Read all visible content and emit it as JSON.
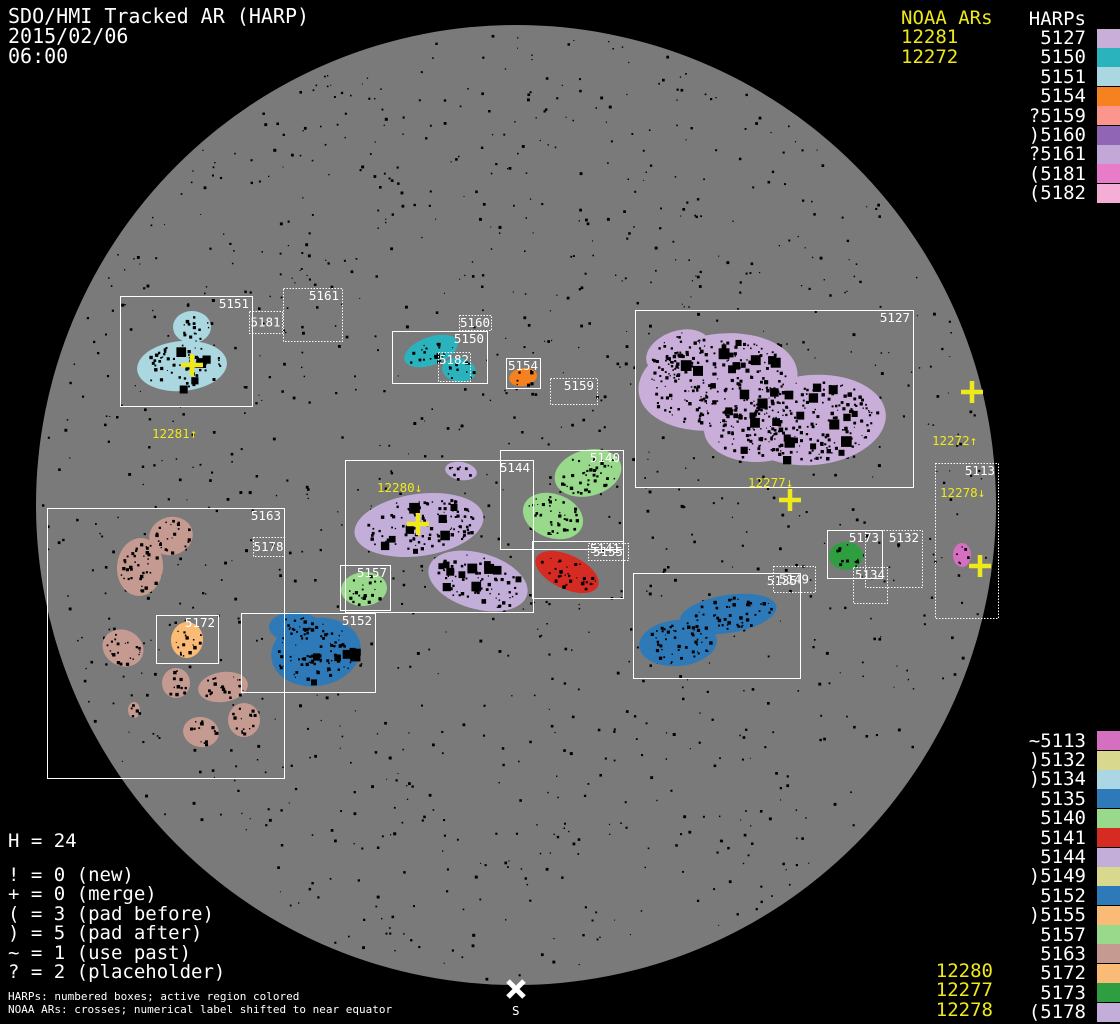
{
  "title": {
    "line1": "SDO/HMI Tracked AR (HARP)",
    "line2": "2015/02/06",
    "line3": "06:00"
  },
  "colors": {
    "background": "#000000",
    "disk": "#7a7a7a",
    "box_stroke": "#ffffff",
    "noaa_yellow": "#efe919",
    "text_white": "#ffffff"
  },
  "noaa_top": {
    "header": "NOAA ARs",
    "items": [
      "12281",
      "12272"
    ]
  },
  "harps_top": {
    "header": "HARPs",
    "items": [
      {
        "label": "5127",
        "color": "#c9aed9"
      },
      {
        "label": "5150",
        "color": "#2bb3bd"
      },
      {
        "label": "5151",
        "color": "#abd7e0"
      },
      {
        "label": "5154",
        "color": "#f5821f"
      },
      {
        "label": "?5159",
        "color": "#fb958d"
      },
      {
        "label": ")5160",
        "color": "#9065b5"
      },
      {
        "label": "?5161",
        "color": "#c3a8d7"
      },
      {
        "label": "(5181",
        "color": "#e87cc8"
      },
      {
        "label": "(5182",
        "color": "#f4aed6"
      }
    ]
  },
  "harps_bottom": {
    "items": [
      {
        "label": "~5113",
        "color": "#d56fc0"
      },
      {
        "label": ")5132",
        "color": "#d8d98f"
      },
      {
        "label": ")5134",
        "color": "#abd7e5"
      },
      {
        "label": "5135",
        "color": "#2e79b8"
      },
      {
        "label": "5140",
        "color": "#98d98c"
      },
      {
        "label": "5141",
        "color": "#d62b23"
      },
      {
        "label": "5144",
        "color": "#c3aed9"
      },
      {
        "label": ")5149",
        "color": "#d8d98f"
      },
      {
        "label": "5152",
        "color": "#2e79b8"
      },
      {
        "label": ")5155",
        "color": "#f9bb76"
      },
      {
        "label": "5157",
        "color": "#98d98c"
      },
      {
        "label": "5163",
        "color": "#c49a91"
      },
      {
        "label": "5172",
        "color": "#f9bb76"
      },
      {
        "label": "5173",
        "color": "#2f9e41"
      },
      {
        "label": "(5178",
        "color": "#c3aed9"
      }
    ]
  },
  "noaa_bottom": {
    "items": [
      "12280",
      "12277",
      "12278"
    ]
  },
  "stats": {
    "harp_count": "H = 24",
    "legend": [
      "! = 0 (new)",
      "+ = 0 (merge)",
      "( = 3 (pad before)",
      ") = 5 (pad after)",
      "~ = 1 (use past)",
      "? = 2 (placeholder)"
    ]
  },
  "footer": {
    "line1": "HARPs: numbered boxes; active region colored",
    "line2": "NOAA ARs: crosses; numerical label shifted to near equator"
  },
  "south_marker_label": "S",
  "scene": {
    "disk": {
      "cx": 516,
      "cy": 505,
      "r": 480
    },
    "boxes": [
      {
        "id": "5151",
        "x": 120,
        "y": 296,
        "w": 132,
        "h": 110,
        "style": "solid",
        "anchor": "tr"
      },
      {
        "id": "5181",
        "x": 249,
        "y": 311,
        "w": 33,
        "h": 22,
        "style": "dotted",
        "anchor": "c"
      },
      {
        "id": "5161",
        "x": 283,
        "y": 288,
        "w": 59,
        "h": 53,
        "style": "dotted",
        "anchor": "tr"
      },
      {
        "id": "5150",
        "x": 392,
        "y": 331,
        "w": 95,
        "h": 52,
        "style": "solid",
        "anchor": "tr"
      },
      {
        "id": "5160",
        "x": 459,
        "y": 315,
        "w": 32,
        "h": 15,
        "style": "dotted",
        "anchor": "c"
      },
      {
        "id": "5182",
        "x": 438,
        "y": 352,
        "w": 32,
        "h": 29,
        "style": "dotted",
        "anchor": "t"
      },
      {
        "id": "5154",
        "x": 506,
        "y": 358,
        "w": 34,
        "h": 30,
        "style": "solid",
        "anchor": "t"
      },
      {
        "id": "5159",
        "x": 550,
        "y": 378,
        "w": 47,
        "h": 26,
        "style": "dotted",
        "anchor": "tr"
      },
      {
        "id": "5127",
        "x": 635,
        "y": 310,
        "w": 278,
        "h": 177,
        "style": "solid",
        "anchor": "tr"
      },
      {
        "id": "5144",
        "x": 345,
        "y": 460,
        "w": 188,
        "h": 152,
        "style": "solid",
        "anchor": "tr"
      },
      {
        "id": "5140",
        "x": 500,
        "y": 450,
        "w": 123,
        "h": 99,
        "style": "solid",
        "anchor": "tr"
      },
      {
        "id": "5141",
        "x": 532,
        "y": 541,
        "w": 91,
        "h": 57,
        "style": "solid",
        "anchor": "tr"
      },
      {
        "id": "5155",
        "x": 588,
        "y": 543,
        "w": 40,
        "h": 17,
        "style": "dotted",
        "anchor": "c"
      },
      {
        "id": "5157",
        "x": 340,
        "y": 565,
        "w": 50,
        "h": 45,
        "style": "solid",
        "anchor": "tr"
      },
      {
        "id": "5163",
        "x": 47,
        "y": 508,
        "w": 237,
        "h": 270,
        "style": "solid",
        "anchor": "tr"
      },
      {
        "id": "5178",
        "x": 253,
        "y": 537,
        "w": 31,
        "h": 19,
        "style": "dotted",
        "anchor": "c"
      },
      {
        "id": "5172",
        "x": 156,
        "y": 615,
        "w": 62,
        "h": 48,
        "style": "solid",
        "anchor": "tr"
      },
      {
        "id": "5152",
        "x": 241,
        "y": 613,
        "w": 134,
        "h": 79,
        "style": "solid",
        "anchor": "tr"
      },
      {
        "id": "5135",
        "x": 633,
        "y": 573,
        "w": 167,
        "h": 105,
        "style": "solid",
        "anchor": "tr"
      },
      {
        "id": "5149",
        "x": 773,
        "y": 566,
        "w": 42,
        "h": 26,
        "style": "dotted",
        "anchor": "c"
      },
      {
        "id": "5173",
        "x": 827,
        "y": 530,
        "w": 55,
        "h": 48,
        "style": "solid",
        "anchor": "tr"
      },
      {
        "id": "5132",
        "x": 865,
        "y": 530,
        "w": 57,
        "h": 57,
        "style": "dotted",
        "anchor": "tr"
      },
      {
        "id": "5134",
        "x": 853,
        "y": 567,
        "w": 34,
        "h": 36,
        "style": "dotted",
        "anchor": "t"
      },
      {
        "id": "5113",
        "x": 935,
        "y": 463,
        "w": 63,
        "h": 155,
        "style": "dotted",
        "anchor": "tr"
      }
    ],
    "blobs": [
      {
        "harp": "5151",
        "color": "#abd7e0",
        "e": [
          [
            192,
            327,
            19,
            16,
            0
          ],
          [
            182,
            366,
            45,
            25,
            -5
          ]
        ]
      },
      {
        "harp": "5150",
        "color": "#2bb3bd",
        "e": [
          [
            431,
            351,
            28,
            14,
            -20
          ],
          [
            459,
            370,
            17,
            12,
            10
          ]
        ]
      },
      {
        "harp": "5154",
        "color": "#f5821f",
        "e": [
          [
            523,
            377,
            14,
            9,
            -10
          ]
        ]
      },
      {
        "harp": "5127",
        "color": "#c9aed9",
        "e": [
          [
            718,
            382,
            80,
            48,
            -8
          ],
          [
            812,
            420,
            74,
            45,
            -5
          ],
          [
            678,
            352,
            33,
            21,
            -20
          ],
          [
            756,
            430,
            52,
            32,
            0
          ]
        ]
      },
      {
        "harp": "5144",
        "color": "#c3aed9",
        "e": [
          [
            461,
            471,
            16,
            9,
            10
          ],
          [
            419,
            525,
            65,
            31,
            -8
          ],
          [
            478,
            581,
            51,
            28,
            16
          ]
        ]
      },
      {
        "harp": "5140",
        "color": "#98d98c",
        "e": [
          [
            588,
            473,
            34,
            23,
            -15
          ],
          [
            553,
            516,
            31,
            22,
            20
          ]
        ]
      },
      {
        "harp": "5141",
        "color": "#d62b23",
        "e": [
          [
            567,
            572,
            34,
            17,
            25
          ]
        ]
      },
      {
        "harp": "5157",
        "color": "#98d98c",
        "e": [
          [
            364,
            589,
            23,
            17,
            -5
          ]
        ]
      },
      {
        "harp": "5163",
        "color": "#c49a91",
        "e": [
          [
            171,
            536,
            22,
            19,
            -15
          ],
          [
            140,
            567,
            23,
            29,
            5
          ],
          [
            123,
            648,
            21,
            18,
            25
          ],
          [
            176,
            683,
            14,
            15,
            0
          ],
          [
            223,
            687,
            25,
            15,
            -8
          ],
          [
            134,
            710,
            6,
            8,
            0
          ],
          [
            201,
            732,
            18,
            15,
            10
          ],
          [
            244,
            720,
            16,
            17,
            0
          ]
        ]
      },
      {
        "harp": "5172",
        "color": "#f9bb76",
        "e": [
          [
            187,
            640,
            16,
            18,
            5
          ]
        ]
      },
      {
        "harp": "5152",
        "color": "#2e79b8",
        "e": [
          [
            316,
            652,
            45,
            34,
            -10
          ],
          [
            295,
            627,
            26,
            15,
            0
          ]
        ]
      },
      {
        "harp": "5135",
        "color": "#2e79b8",
        "e": [
          [
            728,
            614,
            49,
            19,
            -9
          ],
          [
            678,
            643,
            39,
            23,
            -5
          ]
        ]
      },
      {
        "harp": "5173",
        "color": "#2f9e41",
        "e": [
          [
            846,
            556,
            17,
            14,
            0
          ]
        ]
      },
      {
        "harp": "5113",
        "color": "#d56fc0",
        "e": [
          [
            962,
            555,
            9,
            12,
            0
          ]
        ]
      }
    ],
    "crosses": [
      {
        "ar": "12281",
        "x": 192,
        "y": 365,
        "label": "12281↑",
        "lx": 152,
        "ly": 438
      },
      {
        "ar": "12280",
        "x": 418,
        "y": 524,
        "label": "12280↓",
        "lx": 377,
        "ly": 492
      },
      {
        "ar": "12277",
        "x": 790,
        "y": 500,
        "label": "12277↓",
        "lx": 748,
        "ly": 487
      },
      {
        "ar": "12272",
        "x": 972,
        "y": 392,
        "label": "12272↑",
        "lx": 932,
        "ly": 445
      },
      {
        "ar": "12278",
        "x": 980,
        "y": 566,
        "label": "12278↓",
        "lx": 940,
        "ly": 497
      }
    ],
    "south": {
      "x": 516,
      "y": 989
    }
  }
}
